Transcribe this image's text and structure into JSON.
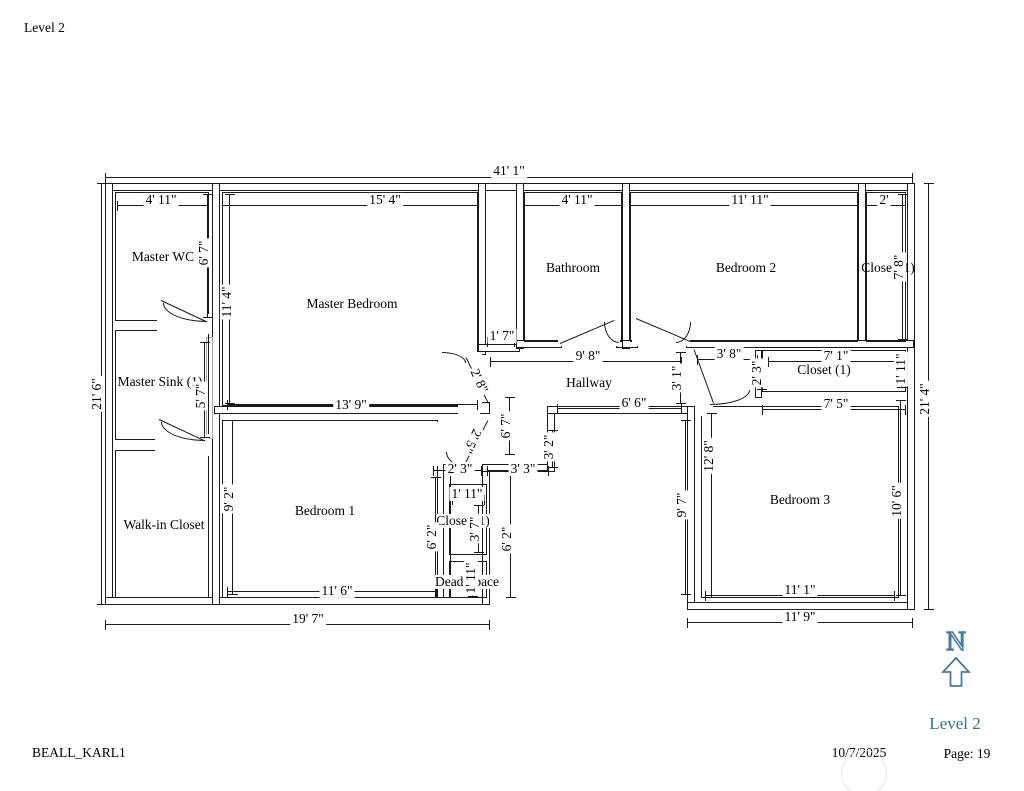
{
  "page": {
    "title": "Level 2",
    "footer_left": "BEALL_KARL1",
    "footer_date": "10/7/2025",
    "footer_page": "Page: 19",
    "footer_level": "Level 2"
  },
  "compass": {
    "letter": "N"
  },
  "colors": {
    "accent_blue": "#35709e",
    "compass_blue": "#4a7a9b",
    "line_black": "#1a1a1a",
    "gray_wall": "#a6a6a6"
  },
  "rooms": {
    "master_wc": "Master WC",
    "master_bedroom": "Master Bedroom",
    "bathroom": "Bathroom",
    "bedroom2": "Bedroom 2",
    "closet_top_right": "Closet (1)",
    "master_sink": "Master Sink (1)",
    "hallway": "Hallway",
    "closet_right_mid": "Closet (1)",
    "walk_in_closet": "Walk-in Closet",
    "bedroom1": "Bedroom 1",
    "closet_center": "Closet (1)",
    "dead_space": "Dead Space",
    "bedroom3": "Bedroom 3"
  },
  "dims": {
    "overall_width": "41' 1\"",
    "left_height": "21' 6\"",
    "right_height": "21' 4\"",
    "master_wc_width": "4' 11\"",
    "master_wc_height": "6' 7\"",
    "master_bedroom_width": "15' 4\"",
    "master_bedroom_height": "11' 4\"",
    "master_bedroom_bottom": "13' 9\"",
    "master_sink_height": "5' 7\"",
    "bathroom_width": "4' 11\"",
    "bedroom2_width": "11' 11\"",
    "closet_top_right_width": "2'",
    "closet_top_right_height": "7' 8\"",
    "chase_width": "1' 7\"",
    "hallway_width": "9' 8\"",
    "hallway_width_lower": "6' 6\"",
    "hallway_column_height": "6' 7\"",
    "door_upper": "2' 8\"",
    "door_lower": "2' 5\"",
    "bedroom3_corridor": "3' 8\"",
    "closet_right_gap": "2' 3\"",
    "closet_right_width": "7' 1\"",
    "closet_right_height": "1' 11\"",
    "closet_right_bottom": "7' 5\"",
    "bedroom3_door_height": "3' 1\"",
    "alcove_left": "2' 3\"",
    "alcove_right": "3' 3\"",
    "alcove_height": "3' 2\"",
    "closet_center_width": "1' 11\"",
    "closet_center_height": "3' 7\"",
    "column_height_left": "6' 2\"",
    "column_height_right": "6' 2\"",
    "dead_space_height": "1' 11\"",
    "bedroom1_height": "9' 2\"",
    "bedroom1_width": "11' 6\"",
    "bottom_left_width": "19' 7\"",
    "bedroom3_height_inner": "12' 8\"",
    "bedroom3_height_left": "9' 7\"",
    "bedroom3_width": "11' 1\"",
    "bedroom3_height_right": "10' 6\"",
    "bottom_right_width": "11' 9\""
  }
}
